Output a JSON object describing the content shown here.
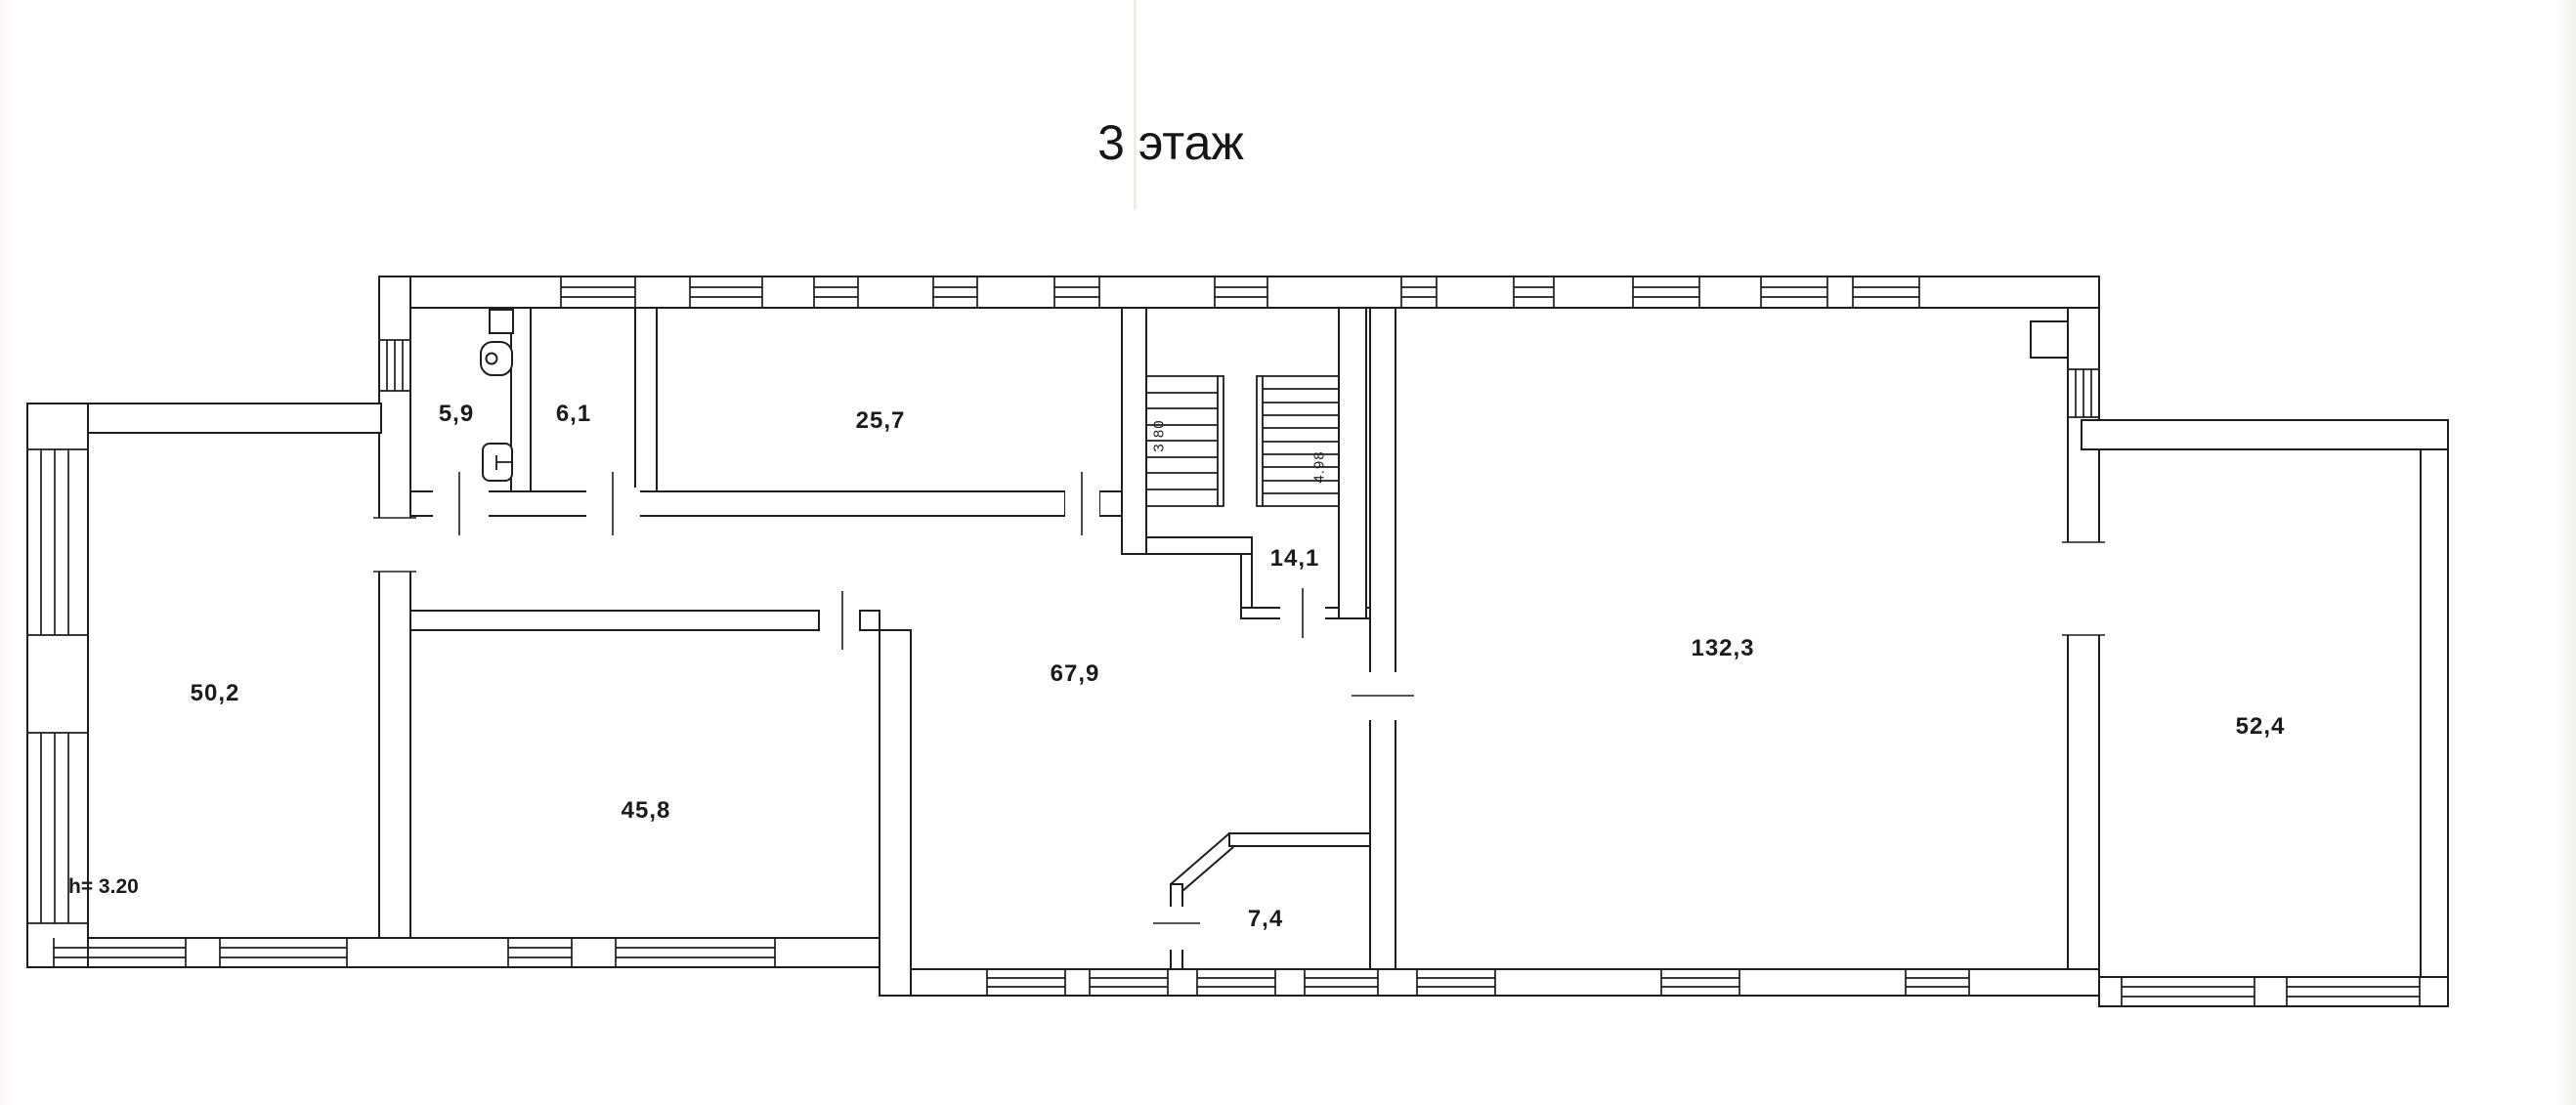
{
  "page": {
    "title": "3 этаж",
    "floor_height_note": "h= 3.20"
  },
  "rooms": [
    {
      "name": "wc-room",
      "area": "5,9"
    },
    {
      "name": "room-6-1",
      "area": "6,1"
    },
    {
      "name": "room-25-7",
      "area": "25,7"
    },
    {
      "name": "stair-lobby",
      "area": "14,1"
    },
    {
      "name": "hall-67-9",
      "area": "67,9"
    },
    {
      "name": "room-45-8",
      "area": "45,8"
    },
    {
      "name": "room-7-4",
      "area": "7,4"
    },
    {
      "name": "hall-132-3",
      "area": "132,3"
    },
    {
      "name": "left-wing-room",
      "area": "50,2"
    },
    {
      "name": "right-wing-room",
      "area": "52,4"
    }
  ],
  "stairs": {
    "flight_a_length": "3.80",
    "flight_b_length": "4.98"
  },
  "colors": {
    "line": "#1e1e1e",
    "paper": "#ffffff"
  }
}
